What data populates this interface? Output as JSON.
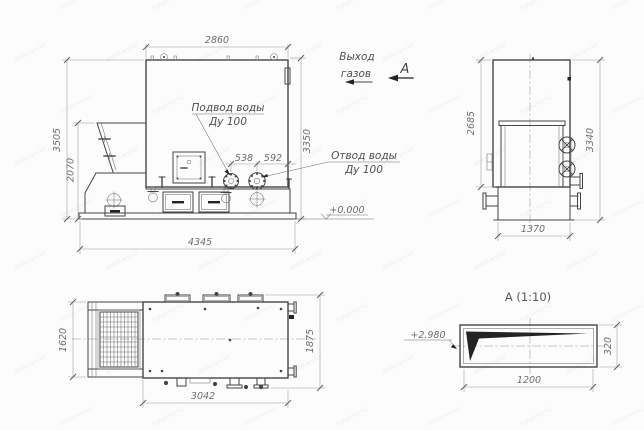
{
  "colors": {
    "background": "#fcfcfc",
    "line": "#454545",
    "dimension": "#979797",
    "dim_text": "#6d6d6d",
    "section_fill": "#232323",
    "watermark": "#94a0ab"
  },
  "drawing": {
    "watermark_text": "kotel-kv.kz",
    "labels": {
      "gas_outlet_line1": "Выход",
      "gas_outlet_line2": "газов",
      "section_arrow": "А",
      "water_inlet_line1": "Подвод воды",
      "water_inlet_line2": "Ду 100",
      "water_outlet_line1": "Отвод воды",
      "water_outlet_line2": "Ду 100",
      "ground_level": "+0.000",
      "section_level": "+2.980",
      "section_title": "А (1:10)"
    },
    "front_view": {
      "dim_top_width": "2860",
      "dim_total_height": "3505",
      "dim_hopper_height": "2070",
      "dim_body_height": "3350",
      "dim_flange_left": "538",
      "dim_flange_right": "592",
      "dim_base_length": "4345"
    },
    "side_view": {
      "dim_body_height": "2685",
      "dim_total_height": "3340",
      "dim_base_width": "1370"
    },
    "plan_view": {
      "dim_hopper_width": "1620",
      "dim_overall_width": "1875",
      "dim_body_length": "3042"
    },
    "section_view": {
      "dim_length": "1200",
      "dim_height": "320"
    }
  }
}
